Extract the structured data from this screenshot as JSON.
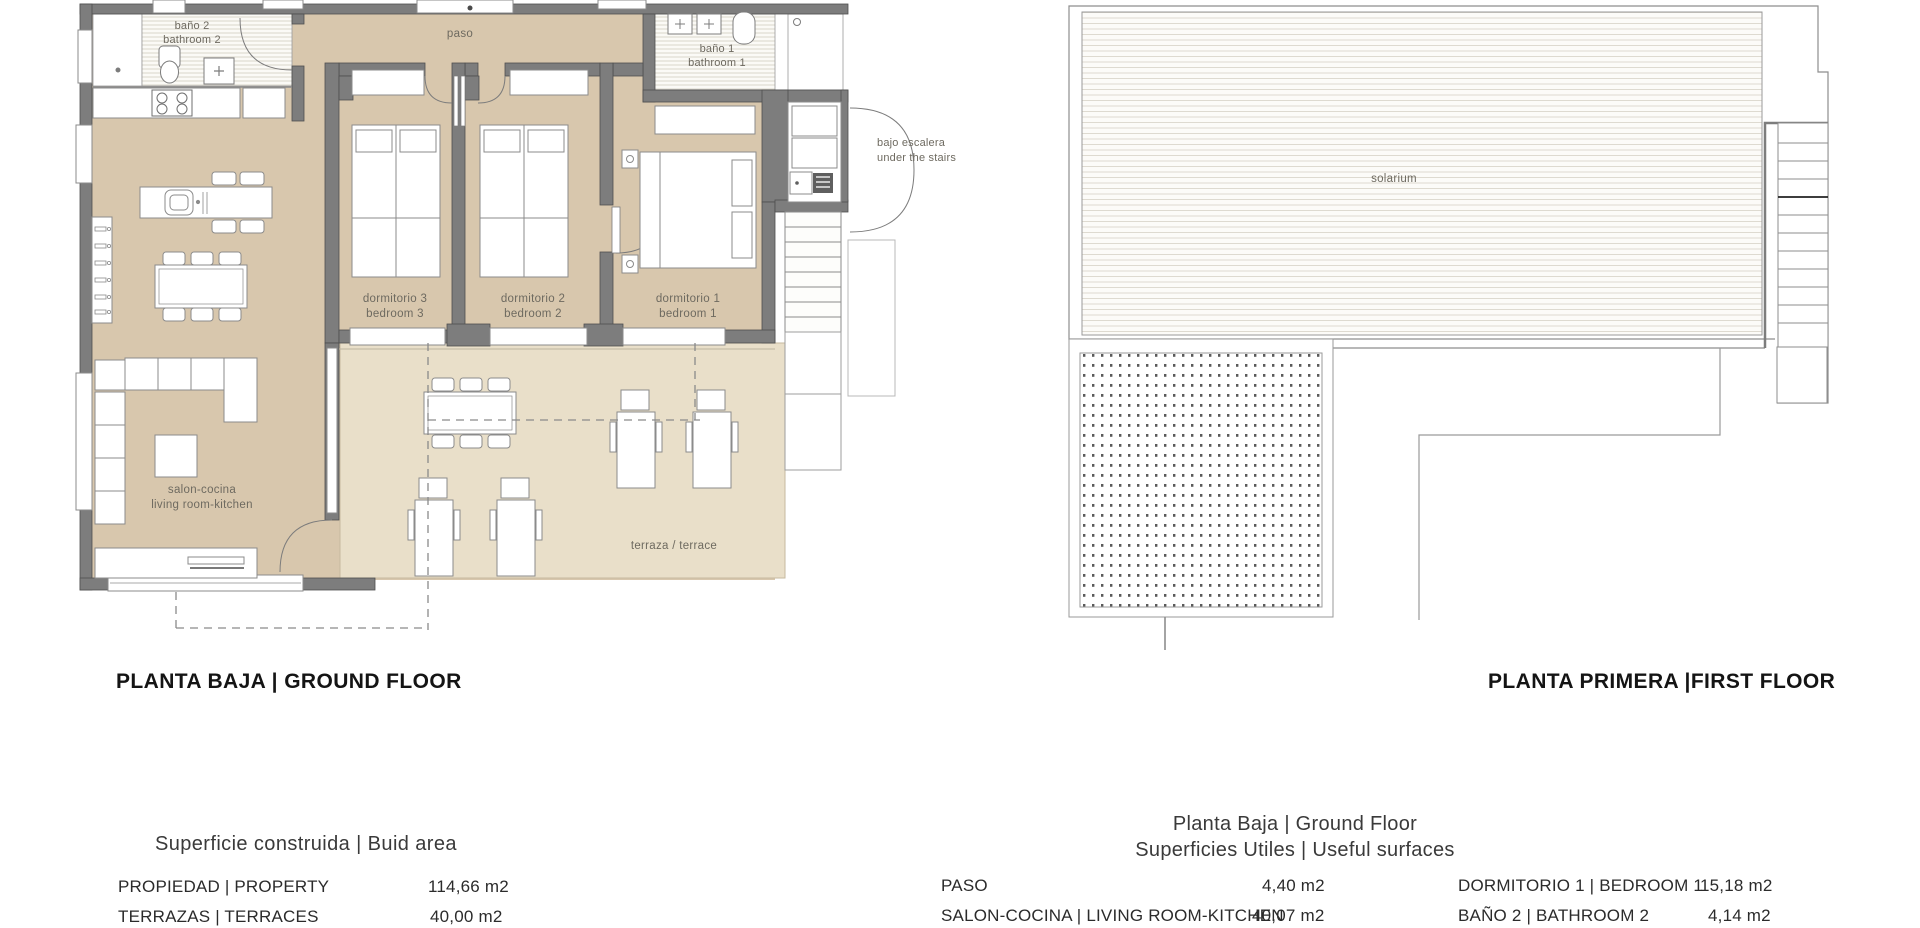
{
  "colors": {
    "wall": "#7d7d7d",
    "wall_stroke": "#4f4f4f",
    "floor_tan": "#d8c7ad",
    "terrace_tan": "#e9dfc9",
    "hatch_line": "#d9d5cb",
    "label_gray": "#6e6a60"
  },
  "ground_floor": {
    "heading": "PLANTA BAJA | GROUND FLOOR",
    "rooms": {
      "bathroom2": {
        "line1": "baño 2",
        "line2": "bathroom 2"
      },
      "bathroom1": {
        "line1": "baño 1",
        "line2": "bathroom 1"
      },
      "paso": "paso",
      "under_stairs": {
        "line1": "bajo escalera",
        "line2": "under the stairs"
      },
      "bedroom3": {
        "line1": "dormitorio 3",
        "line2": "bedroom 3"
      },
      "bedroom2": {
        "line1": "dormitorio 2",
        "line2": "bedroom 2"
      },
      "bedroom1": {
        "line1": "dormitorio 1",
        "line2": "bedroom 1"
      },
      "living": {
        "line1": "salon-cocina",
        "line2": "living room-kitchen"
      },
      "terrace": "terraza / terrace"
    }
  },
  "first_floor": {
    "heading": "PLANTA PRIMERA |FIRST FLOOR",
    "rooms": {
      "solarium": "solarium"
    }
  },
  "built_area": {
    "title": "Superficie construida | Buid area",
    "rows": [
      {
        "label": "PROPIEDAD | PROPERTY",
        "value": "114,66 m2"
      },
      {
        "label": "TERRAZAS | TERRACES",
        "value": "40,00 m2"
      }
    ]
  },
  "useful_surfaces": {
    "title_line1": "Planta Baja | Ground Floor",
    "title_line2": "Superficies Utiles | Useful surfaces",
    "left_rows": [
      {
        "label": "PASO",
        "value": "4,40 m2"
      },
      {
        "label": "SALON-COCINA | LIVING ROOM-KITCHEN",
        "value": "40,07 m2"
      }
    ],
    "right_rows": [
      {
        "label": "DORMITORIO 1 | BEDROOM 1",
        "value": "15,18 m2"
      },
      {
        "label": "BAÑO 2 | BATHROOM 2",
        "value": "4,14 m2"
      }
    ]
  }
}
